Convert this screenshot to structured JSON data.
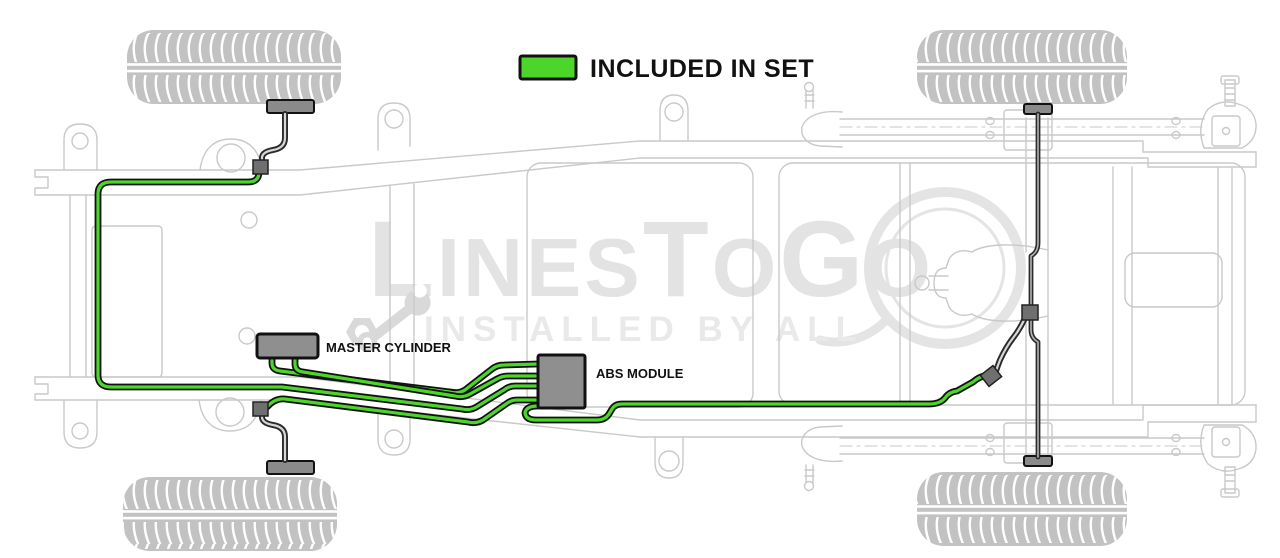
{
  "legend": {
    "label": "INCLUDED IN SET"
  },
  "labels": {
    "master_cylinder": "MASTER CYLINDER",
    "abs_module": "ABS MODULE"
  },
  "watermark": {
    "parts": [
      "L",
      "INES",
      "T",
      "O",
      "G",
      "O"
    ],
    "tagline": "INSTALLED BY ALL"
  },
  "colors": {
    "included_green": "#4cd62a",
    "line_outline": "#111111",
    "component_gray": "#8f8f8f",
    "chassis_gray": "#c9c9c9",
    "tire_gray": "#c2c2c2",
    "watermark_gray": "#e3e3e3"
  }
}
